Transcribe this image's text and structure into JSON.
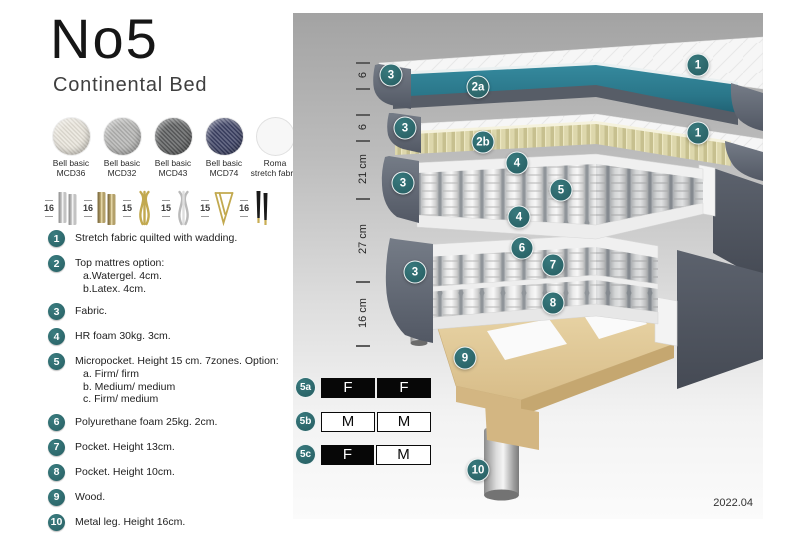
{
  "header": {
    "title": "No5",
    "subtitle": "Continental Bed"
  },
  "fabrics": [
    {
      "name": "Bell basic",
      "code": "MCD36",
      "color": "#e8e4da",
      "woven": true
    },
    {
      "name": "Bell basic",
      "code": "MCD32",
      "color": "#b4b4b2",
      "woven": true
    },
    {
      "name": "Bell basic",
      "code": "MCD43",
      "color": "#5b5d5e",
      "woven": true
    },
    {
      "name": "Bell basic",
      "code": "MCD74",
      "color": "#3b4063",
      "woven": true
    },
    {
      "name": "Roma",
      "code": "stretch fabric",
      "color": "#f7f7f7",
      "woven": false
    }
  ],
  "legs": [
    {
      "height": "16",
      "type": "cylinder-silver"
    },
    {
      "height": "16",
      "type": "cylinder-brass"
    },
    {
      "height": "15",
      "type": "twisted-gold"
    },
    {
      "height": "15",
      "type": "twisted-silver"
    },
    {
      "height": "15",
      "type": "hairpin-gold"
    },
    {
      "height": "16",
      "type": "tapered-black"
    }
  ],
  "spec_list": [
    {
      "num": "1",
      "text": "Stretch fabric quilted with wadding.",
      "subs": []
    },
    {
      "num": "2",
      "text": "Top mattres option:",
      "subs": [
        "a.Watergel. 4cm.",
        "b.Latex. 4cm."
      ]
    },
    {
      "num": "3",
      "text": "Fabric.",
      "subs": []
    },
    {
      "num": "4",
      "text": "HR foam 30kg. 3cm.",
      "subs": []
    },
    {
      "num": "5",
      "text": "Micropocket. Height 15 cm. 7zones. Option:",
      "subs": [
        "a. Firm/ firm",
        "b. Medium/ medium",
        "c. Firm/ medium"
      ]
    },
    {
      "num": "6",
      "text": "Polyurethane foam 25kg. 2cm.",
      "subs": []
    },
    {
      "num": "7",
      "text": "Pocket. Height 13cm.",
      "subs": []
    },
    {
      "num": "8",
      "text": "Pocket. Height 10cm.",
      "subs": []
    },
    {
      "num": "9",
      "text": "Wood.",
      "subs": []
    },
    {
      "num": "10",
      "text": "Metal leg. Height 16cm.",
      "subs": []
    }
  ],
  "diagram": {
    "ruler": [
      {
        "label": "6"
      },
      {
        "label": "6"
      },
      {
        "label": "21 cm"
      },
      {
        "label": "27 cm"
      },
      {
        "label": "16 cm"
      }
    ],
    "callouts": [
      {
        "label": "1"
      },
      {
        "label": "3"
      },
      {
        "label": "2a"
      },
      {
        "label": "1"
      },
      {
        "label": "3"
      },
      {
        "label": "2b"
      },
      {
        "label": "4"
      },
      {
        "label": "5"
      },
      {
        "label": "4"
      },
      {
        "label": "3"
      },
      {
        "label": "6"
      },
      {
        "label": "7"
      },
      {
        "label": "3"
      },
      {
        "label": "8"
      },
      {
        "label": "9"
      },
      {
        "label": "10"
      }
    ],
    "firmness": [
      {
        "label": "5a",
        "cells": [
          {
            "text": "F",
            "variant": "dark"
          },
          {
            "text": "F",
            "variant": "dark"
          }
        ]
      },
      {
        "label": "5b",
        "cells": [
          {
            "text": "M",
            "variant": "light"
          },
          {
            "text": "M",
            "variant": "light"
          }
        ]
      },
      {
        "label": "5c",
        "cells": [
          {
            "text": "F",
            "variant": "dark"
          },
          {
            "text": "M",
            "variant": "light"
          }
        ]
      }
    ],
    "version": "2022.04"
  },
  "colors": {
    "accent_teal": "#2e6f73",
    "watergel_teal": "#2b7b8e",
    "latex_yellow": "#d9d3a8",
    "fabric_gray": "#5f6570",
    "wood_tan": "#ddc493"
  }
}
